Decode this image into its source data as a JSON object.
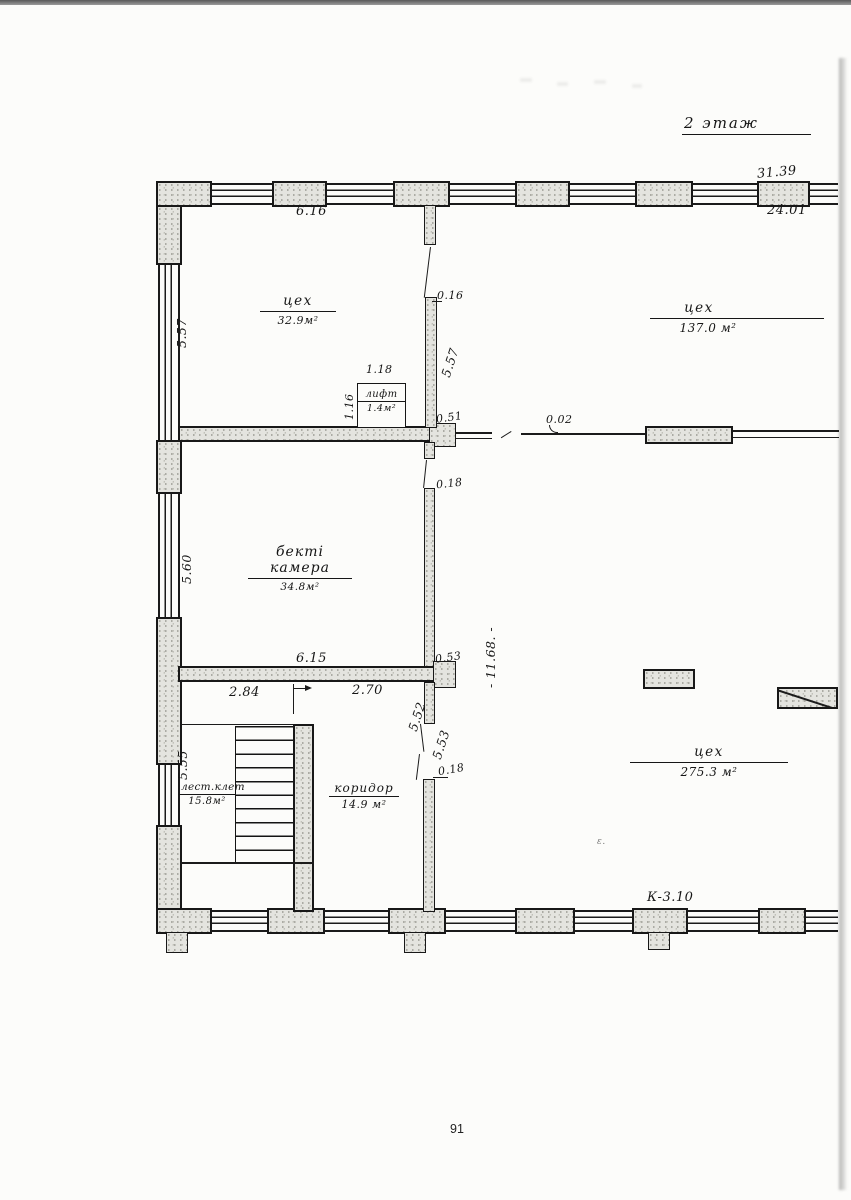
{
  "page": {
    "number": "91",
    "floor_title": "2 этаж"
  },
  "colors": {
    "ink": "#1b1b1b",
    "paper": "#fcfcfa",
    "masonry_fill": "#e4e4df"
  },
  "rooms": [
    {
      "id": "workshop-top-left",
      "name": "цех",
      "area": "32.9м²"
    },
    {
      "id": "workshop-top-right",
      "name": "цех",
      "area": "137.0 м²"
    },
    {
      "id": "lift",
      "name": "лифт",
      "area": "1.4м²"
    },
    {
      "id": "chamber",
      "name": "бекті камера",
      "area": "34.8м²"
    },
    {
      "id": "staircase",
      "name": "лест.клет",
      "area": "15.8м²"
    },
    {
      "id": "corridor",
      "name": "коридор",
      "area": "14.9 м²"
    },
    {
      "id": "workshop-large",
      "name": "цех",
      "area": "275.3 м²"
    }
  ],
  "dimensions": {
    "top_total": "31.39",
    "top_inner": "24.01",
    "room1_width": "6.16",
    "left_window_upper": "5.57",
    "left_window_middle": "5.60",
    "left_window_lower": "5.55",
    "mid_wall_offset": "0.16",
    "mid_wall_length": "5.57",
    "lift_width": "1.18",
    "lift_depth": "1.16",
    "junction_051": "0.51",
    "thin_wall_002": "0.02",
    "mid_door_018": "0.18",
    "big_room_depth": "- 11.68. -",
    "partition_length": "6.15",
    "partition_end_053": "0.53",
    "seg_284": "2.84",
    "seg_270": "2.70",
    "corridor_upper_552": "5.52",
    "corridor_lower_553": "5.53",
    "corridor_door_018": "0.18",
    "bottom_mark": "К-3.10"
  },
  "artifacts": {
    "stray_mark": "ε."
  }
}
